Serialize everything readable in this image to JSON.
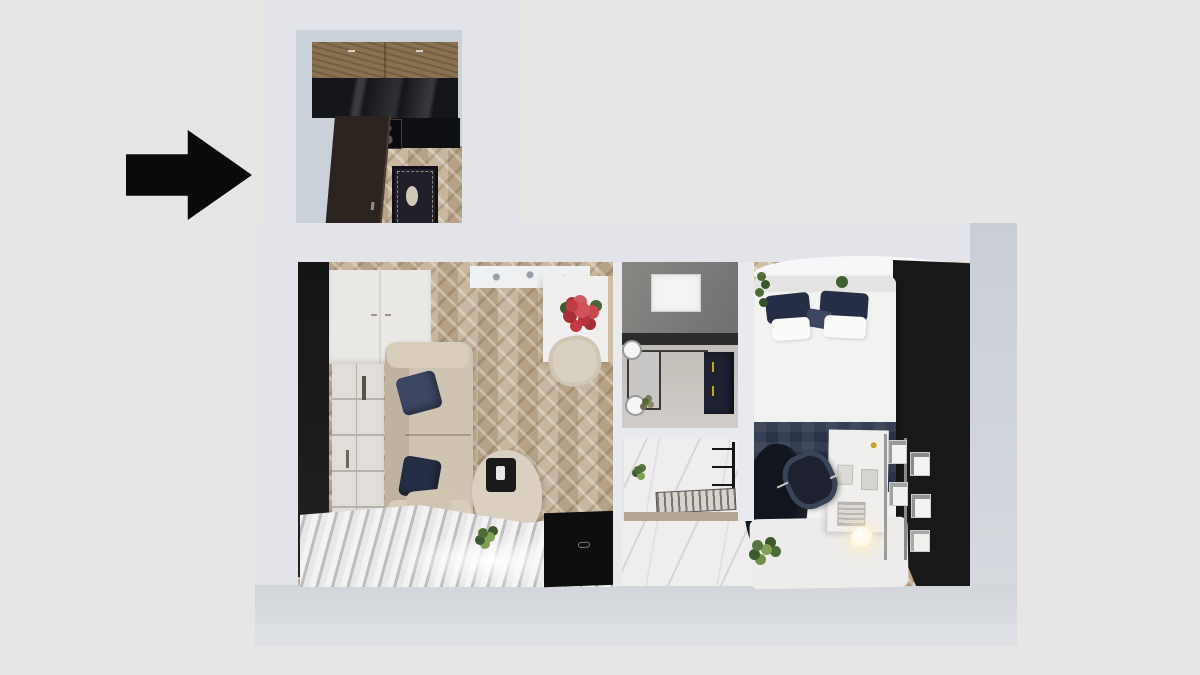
{
  "scene": {
    "title": "floor-plan-render"
  },
  "annotation": {
    "type": "arrow",
    "direction": "right"
  },
  "colors": {
    "bg": "#e7e6e5",
    "wall": "#e2e4e9",
    "wallRightA": "#c9ced6",
    "wallRightB": "#d8dbe0",
    "wallBottomA": "#d2d5da",
    "wallBottomB": "#dfe1e5",
    "sepWall": "#e8eaee",
    "black": "#181818",
    "arrow": "#0a0a0a",
    "woodFloor": "#c3b094",
    "kitchenWood": "#8a7150",
    "kitchenCounter": "#15161a",
    "appliance": "#0f1013",
    "door": "#2c241e",
    "rugKitchen": "#21202a",
    "rugMedallion": "#cfc8b6",
    "kitchenWall": "#cbd1d8",
    "sofa": "#cdc4b2",
    "sofaShade": "#bdb3a0",
    "armrest": "#d6cdbb",
    "pillowNavy": "#3d4763",
    "pillowNavyDark": "#252e45",
    "wardrobe": "#eae8e4",
    "shelf": "#e0ddd8",
    "desk": "#f0efed",
    "flowerRed": "#c33b42",
    "chairBeige": "#d8d1c1",
    "tableWood": "#d9d0c2",
    "tray": "#1a1a1a",
    "curtainA": "#f3f3f3",
    "curtainB": "#bdbdbf",
    "tv": "#0e0e0e",
    "bathWallTop": "#8a8884",
    "bathWallBottom": "#6f6f71",
    "bathCounter": "#2c2c2e",
    "bathFloorA": "#b0aba5",
    "bathFloorB": "#d2cfca",
    "mirror": "#c9c7c5",
    "navyCab": "#1e2130",
    "gold": "#c9a227",
    "bedWhite": "#f2f2f1",
    "headboard": "#e4e4e2",
    "runner": "#2a3449",
    "throw": "#11151e",
    "green": "#4e6b38",
    "greenLight": "#7fa055",
    "marble": "#efeeec",
    "tanWall": "#b3a694",
    "rugToilet": "#d8d4cd",
    "whiteRug": "#edecea",
    "ceilingPanel": "#eef0f1",
    "lampGlow": "#fff6df"
  }
}
